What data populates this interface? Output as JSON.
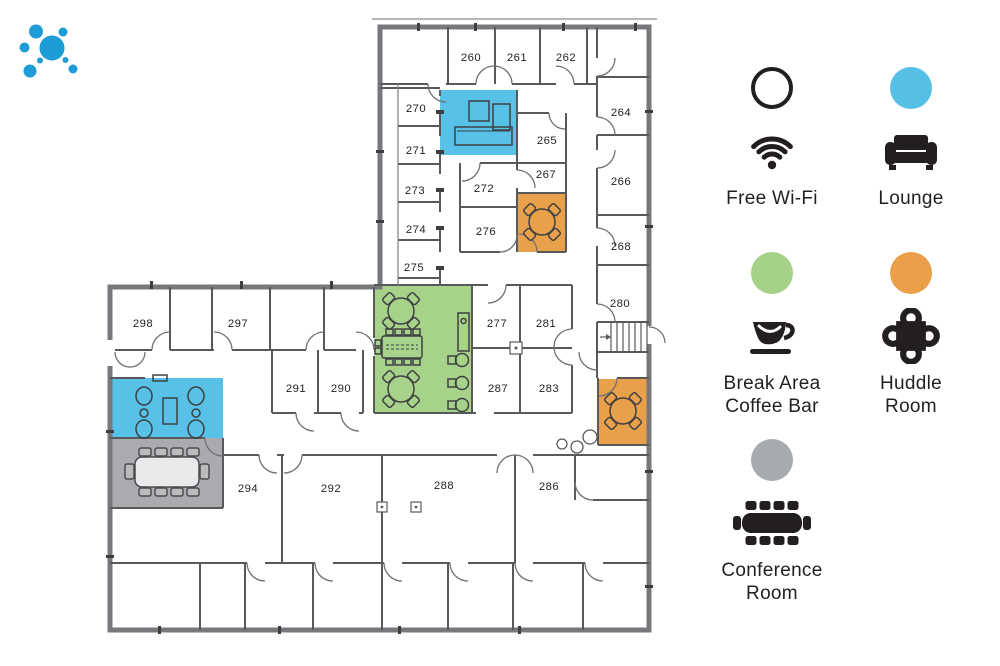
{
  "logo": {
    "name": "dots-logo",
    "color": "#1e9cd8"
  },
  "colors": {
    "wall": "#58595b",
    "outer_wall": "#77787b",
    "text": "#231f20"
  },
  "floorplan": {
    "zones": [
      {
        "name": "lounge-upper",
        "type": "Lounge",
        "color": "#57c1e8",
        "x": 440,
        "y": 90,
        "w": 77,
        "h": 65
      },
      {
        "name": "lounge-lower",
        "type": "Lounge",
        "color": "#57c1e8",
        "x": 112,
        "y": 378,
        "w": 111,
        "h": 60
      },
      {
        "name": "break-area-coffee-bar",
        "type": "Break Area Coffee Bar",
        "color": "#a7d28a",
        "x": 375,
        "y": 286,
        "w": 97,
        "h": 127
      },
      {
        "name": "huddle-room-upper",
        "type": "Huddle Room",
        "color": "#e9a04b",
        "x": 518,
        "y": 193,
        "w": 48,
        "h": 59
      },
      {
        "name": "huddle-room-lower",
        "type": "Huddle Room",
        "color": "#e9a04b",
        "x": 598,
        "y": 379,
        "w": 51,
        "h": 66
      },
      {
        "name": "conference-room",
        "type": "Conference Room",
        "color": "#a9abae",
        "x": 112,
        "y": 438,
        "w": 111,
        "h": 70
      }
    ],
    "rooms": [
      {
        "number": "260",
        "x": 471,
        "y": 61
      },
      {
        "number": "261",
        "x": 517,
        "y": 61
      },
      {
        "number": "262",
        "x": 566,
        "y": 61
      },
      {
        "number": "264",
        "x": 621,
        "y": 116
      },
      {
        "number": "265",
        "x": 547,
        "y": 144
      },
      {
        "number": "266",
        "x": 621,
        "y": 185
      },
      {
        "number": "267",
        "x": 546,
        "y": 178
      },
      {
        "number": "268",
        "x": 621,
        "y": 250
      },
      {
        "number": "270",
        "x": 416,
        "y": 112
      },
      {
        "number": "271",
        "x": 416,
        "y": 154
      },
      {
        "number": "272",
        "x": 484,
        "y": 192
      },
      {
        "number": "273",
        "x": 415,
        "y": 194
      },
      {
        "number": "274",
        "x": 416,
        "y": 233
      },
      {
        "number": "275",
        "x": 414,
        "y": 271
      },
      {
        "number": "276",
        "x": 486,
        "y": 235
      },
      {
        "number": "277",
        "x": 497,
        "y": 327
      },
      {
        "number": "280",
        "x": 620,
        "y": 307
      },
      {
        "number": "281",
        "x": 546,
        "y": 327
      },
      {
        "number": "283",
        "x": 549,
        "y": 392
      },
      {
        "number": "286",
        "x": 549,
        "y": 490
      },
      {
        "number": "287",
        "x": 498,
        "y": 392
      },
      {
        "number": "288",
        "x": 444,
        "y": 489
      },
      {
        "number": "290",
        "x": 341,
        "y": 392
      },
      {
        "number": "291",
        "x": 296,
        "y": 392
      },
      {
        "number": "292",
        "x": 331,
        "y": 492
      },
      {
        "number": "294",
        "x": 248,
        "y": 492
      },
      {
        "number": "297",
        "x": 238,
        "y": 327
      },
      {
        "number": "298",
        "x": 143,
        "y": 327
      }
    ]
  },
  "legend": {
    "items": [
      {
        "id": "free-wifi",
        "icon": "wifi-icon",
        "circle_color": "#ffffff",
        "circle_border": "#231f20",
        "label_lines": [
          "Free Wi-Fi"
        ]
      },
      {
        "id": "lounge",
        "icon": "couch-icon",
        "circle_color": "#55bfe6",
        "circle_border": null,
        "label_lines": [
          "Lounge"
        ]
      },
      {
        "id": "break-area-coffee-bar",
        "icon": "coffee-cup-icon",
        "circle_color": "#a5d189",
        "circle_border": null,
        "label_lines": [
          "Break Area",
          "Coffee Bar"
        ]
      },
      {
        "id": "huddle-room",
        "icon": "huddle-table-icon",
        "circle_color": "#eb9f4a",
        "circle_border": null,
        "label_lines": [
          "Huddle",
          "Room"
        ]
      },
      {
        "id": "conference-room",
        "icon": "conference-table-icon",
        "circle_color": "#a8abae",
        "circle_border": null,
        "label_lines": [
          "Conference",
          "Room"
        ]
      }
    ]
  }
}
